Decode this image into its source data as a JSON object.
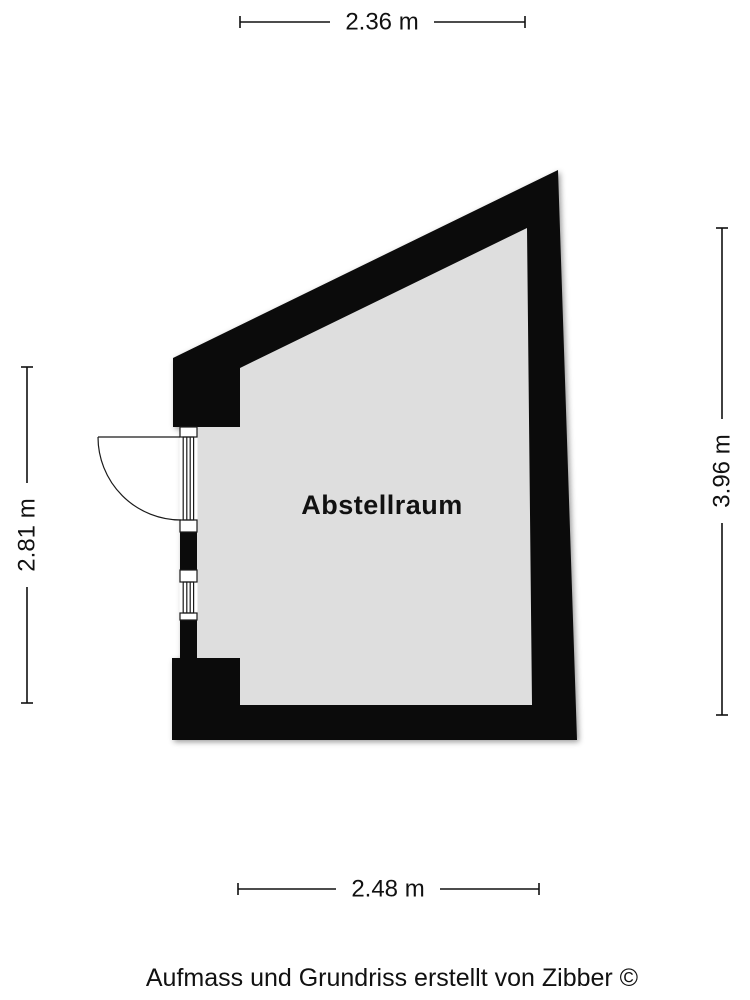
{
  "room": {
    "label": "Abstellraum"
  },
  "dimensions": {
    "top": "2.36 m",
    "right": "3.96 m",
    "left": "2.81 m",
    "bottom": "2.48 m"
  },
  "footer": {
    "credit": "Aufmass und Grundriss erstellt von Zibber ©"
  },
  "colors": {
    "wall": "#0b0b0b",
    "floor": "#dedede",
    "opening": "#ffffff",
    "background": "#ffffff"
  }
}
